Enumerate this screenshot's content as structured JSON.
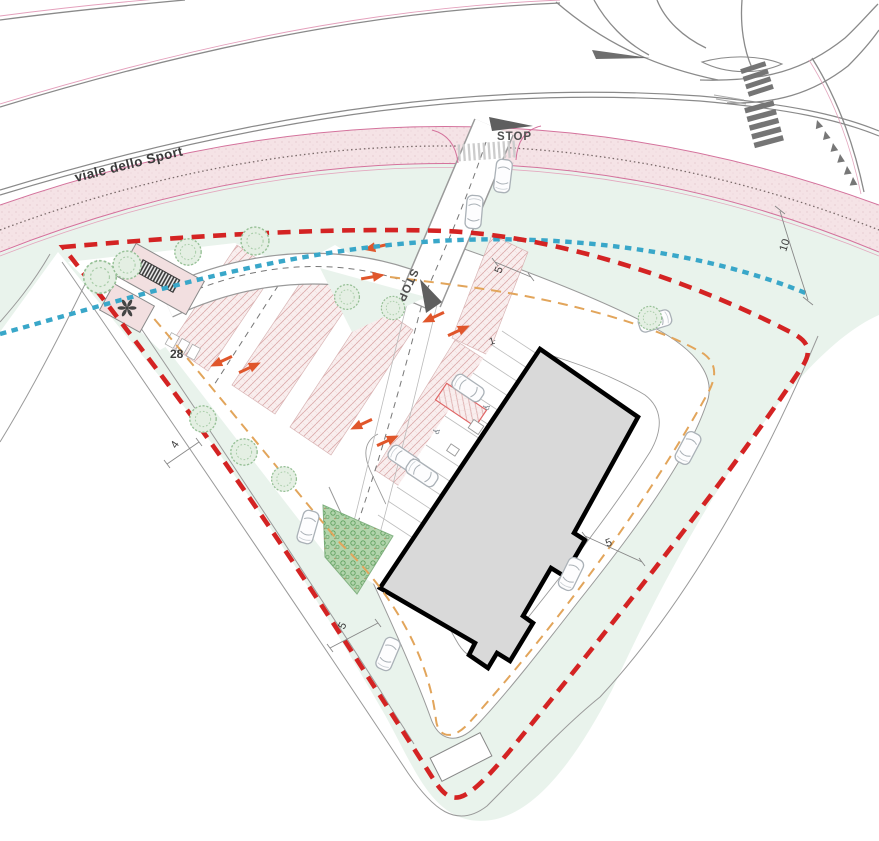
{
  "document": {
    "type": "architectural site plan"
  },
  "road": {
    "name": "viale dello Sport"
  },
  "labels": {
    "stop_entrance": "STOP",
    "stop_internal": "STOP"
  },
  "dimensions": {
    "parking_width": "28",
    "verge_width": "10",
    "entrance_width": "5",
    "east_drive_width": "5",
    "south_drive_width": "5",
    "road_width": "4",
    "stall_number": "1"
  },
  "icons": {
    "accessible_parking": "♿"
  },
  "colors": {
    "boundary_red": "#d42323",
    "utility_blue": "#39a7c9",
    "circulation_orange": "#e2a55b",
    "arrow_orange": "#e0562b",
    "site_green": "#e9f3ec",
    "cycleway_pink": "#f5e3e6",
    "building_fill": "#d9d9d9",
    "building_outline": "#000000",
    "road_edge_gray": "#8a8a8a"
  }
}
